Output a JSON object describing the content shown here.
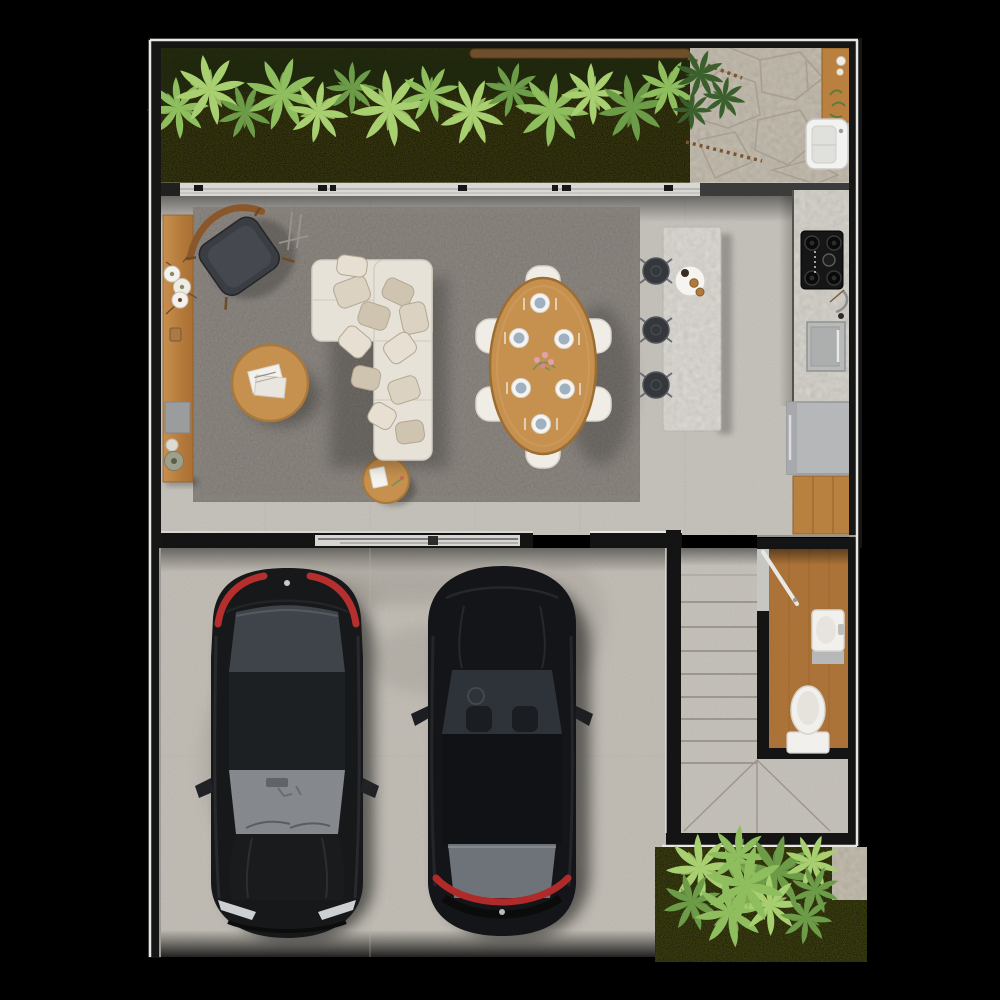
{
  "meta": {
    "render_type": "photoreal top-down 3D floor plan render",
    "floor": "ground floor",
    "visible_text": "none"
  },
  "palette": {
    "background": "#000000",
    "wall": "#1b1b1b",
    "frame_line": "#e9e7e2",
    "grass": "#50501a",
    "grass_rear": "#565a1d",
    "plant_light": "#a8cf70",
    "plant_mid": "#8fbe5f",
    "plant_dark": "#6d9c49",
    "plant_deep": "#3a5f2c",
    "patio_stone": "#cbc4b6",
    "stone_joint": "#a79d8d",
    "floor_tile": "#cdcac3",
    "tile_joint": "#bcb8b1",
    "garage_floor": "#c9c4bc",
    "rug": "#96908a",
    "wood": "#c6914f",
    "wood_dark": "#a96f33",
    "wood_cabinet": "#b9813f",
    "bathroom_wood": "#b57a3c",
    "sofa": "#e7e2d8",
    "chair_white": "#f0ede6",
    "island_stone": "#e5e2dc",
    "counter_stone": "#dedbd4",
    "stool": "#34373b",
    "cooktop": "#161616",
    "appliance_gray": "#b5b7b9",
    "car_body": "#17181a",
    "car_glass": "#3f444a",
    "car_glass_light": "#85898e",
    "taillight_red": "#c03030",
    "porcelain": "#f2f0ec",
    "stair_tread": "#cdc9c2",
    "tread_line": "#8f8a82",
    "plate_blue": "#9fb0c0",
    "flower_pink": "#e0a0ac"
  },
  "rooms": {
    "front_garden": {
      "name": "Front garden strip",
      "features": [
        "lawn",
        "tropical shrub row",
        "driftwood branch",
        "stick edging"
      ]
    },
    "side_patio": {
      "name": "Stone service patio",
      "features": [
        "flagstone paving",
        "wood bench with decor",
        "laundry basin"
      ]
    },
    "living_room": {
      "name": "Living room",
      "furniture": [
        "area rug",
        "modular L-sofa with scatter cushions",
        "round coffee table with magazines",
        "round side table with notebook",
        "wood sideboard with plates and vase",
        "reading chair",
        "easel stand"
      ]
    },
    "dining_area": {
      "name": "Dining area",
      "furniture": [
        "oval wood dining table",
        "six upholstered chairs",
        "six place settings",
        "flower centerpiece"
      ]
    },
    "kitchen": {
      "name": "Kitchen",
      "furniture": [
        "terrazzo island with serving tray",
        "three bar stools",
        "counter run",
        "four-burner cooktop",
        "wall oven",
        "refrigerator",
        "wood base cabinet",
        "faucet"
      ]
    },
    "garage": {
      "name": "Two-car garage",
      "furniture": [
        "black sedan parked nose-out",
        "black sedan parked nose-in"
      ]
    },
    "stair_hall": {
      "name": "Staircase hall",
      "furniture": [
        "straight stair flight",
        "winder landing"
      ]
    },
    "bathroom": {
      "name": "Guest bathroom",
      "furniture": [
        "wood plank floor",
        "vanity with basin",
        "toilet",
        "inswing door"
      ]
    },
    "back_garden": {
      "name": "Rear garden patch",
      "features": [
        "lawn",
        "tropical shrub cluster",
        "concrete strip"
      ]
    }
  },
  "counts": {
    "cars": 2,
    "dining_chairs": 6,
    "place_settings": 6,
    "bar_stools": 3,
    "stair_treads": 8,
    "cooktop_burners": 4,
    "gardens": 2
  }
}
